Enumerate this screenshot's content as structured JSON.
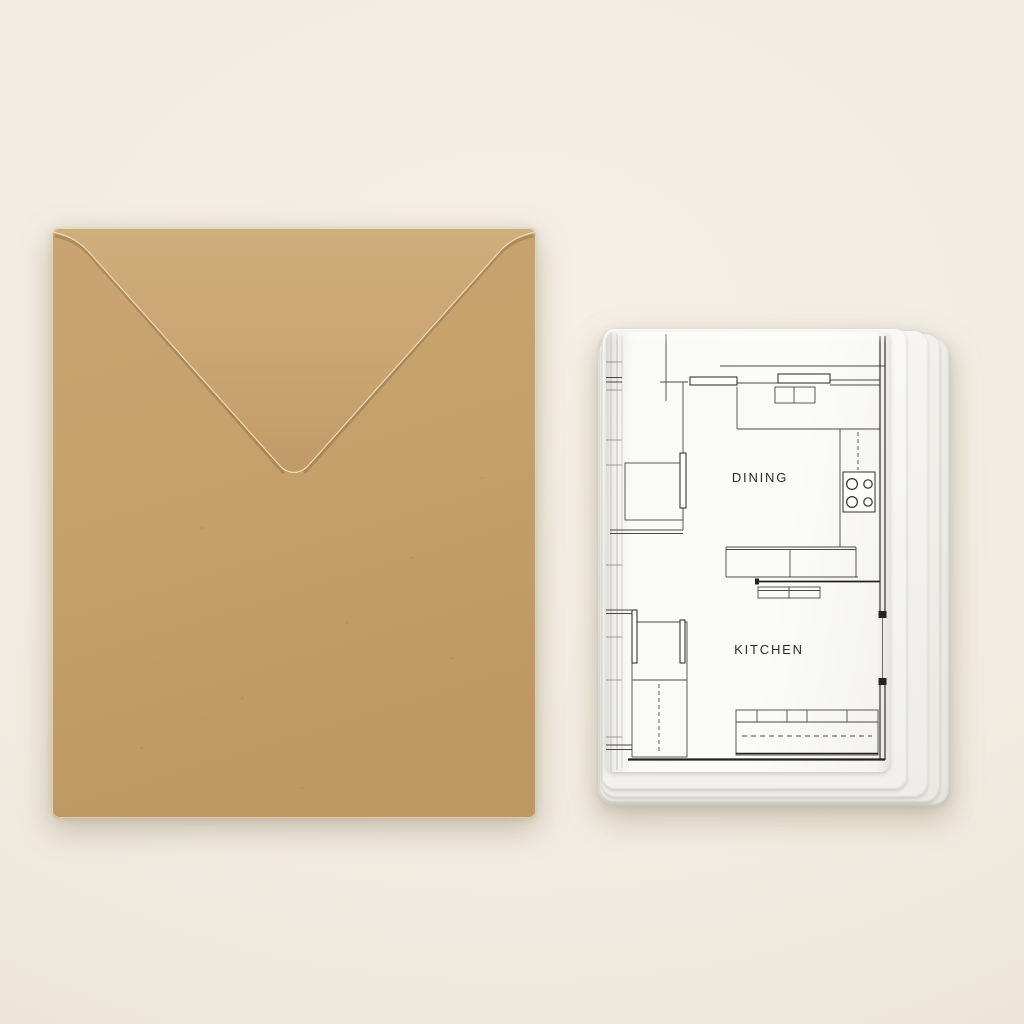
{
  "scene": {
    "description": "Flat-lay photo of a kraft paper envelope next to a stack of folded white cards printed with an architectural floor plan",
    "background_color": "#f0ece1"
  },
  "envelope": {
    "name": "kraft envelope",
    "body_color": "#c6a26d",
    "flap_color": "#cdac7b",
    "edge_highlight_color": "#ecdcba"
  },
  "stack": {
    "name": "floor plan card stack",
    "sheet_color": "#fbfbfa",
    "line_color": "#4b4946",
    "wall_color": "#23211f",
    "labels": {
      "dining": "DINING",
      "kitchen": "KITCHEN"
    }
  }
}
